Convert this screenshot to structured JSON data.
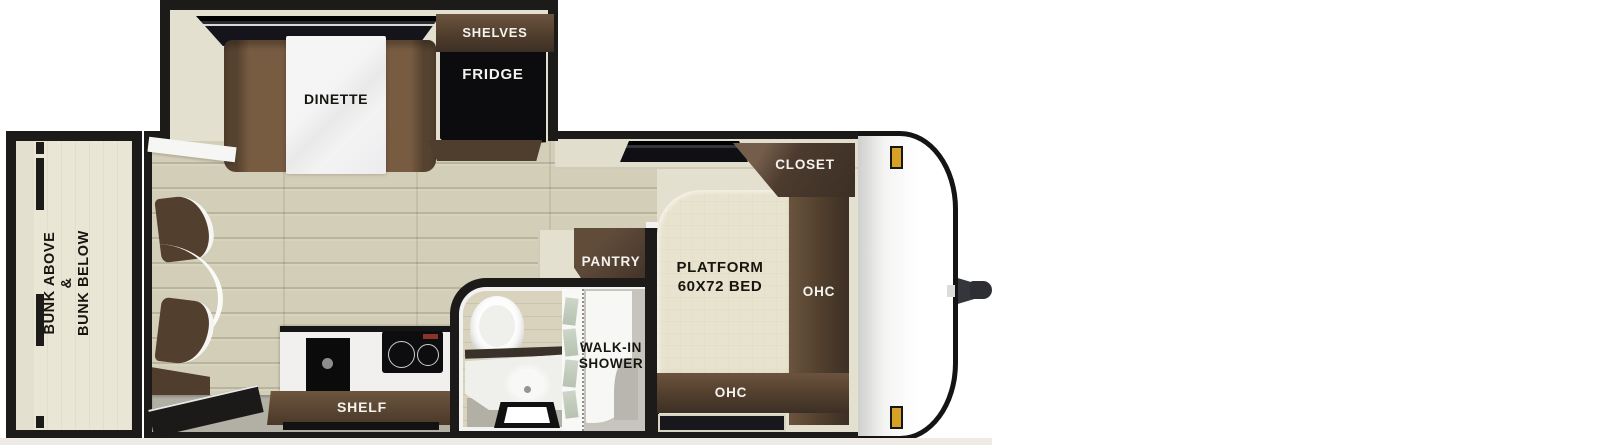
{
  "plan_type": "travel-trailer floorplan",
  "colors": {
    "wall": "#1d1b19",
    "interior_wall": "#e4e0d0",
    "wood_floor": "#d2ceb7",
    "cabinet_dark": "#3c2f25",
    "cabinet_light": "#6b543f",
    "seat_brown": "#75593f",
    "bed_beige": "#e8e3ce",
    "gray_floor": "#b2afa5",
    "appliance_black": "#0c0c0e",
    "marker_amber": "#d7a126",
    "shower_glass": "#c6cfc0"
  },
  "labels": {
    "bunk": {
      "line1": "BUNK ABOVE",
      "line2": "&",
      "line3": "BUNK BELOW"
    },
    "dinette": "DINETTE",
    "shelves": "SHELVES",
    "fridge": "FRIDGE",
    "pantry": "PANTRY",
    "shelf": "SHELF",
    "walk_in_shower": {
      "line1": "WALK-IN",
      "line2": "SHOWER"
    },
    "platform_bed": {
      "line1": "PLATFORM",
      "line2": "60X72 BED"
    },
    "closet": "CLOSET",
    "ohc_side": "OHC",
    "ohc_foot": "OHC"
  }
}
